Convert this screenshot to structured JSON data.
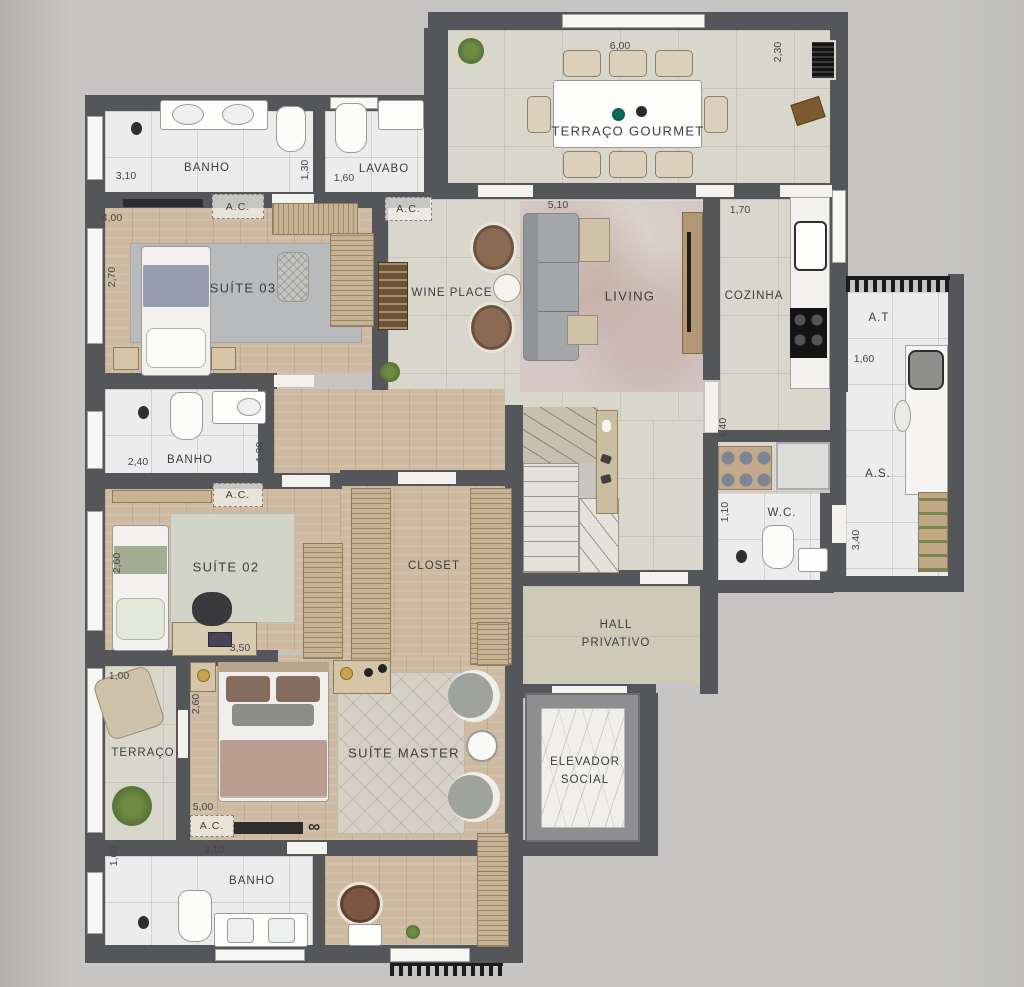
{
  "rooms": {
    "terraco_gourmet": "TERRAÇO GOURMET",
    "banho_suite03": "BANHO",
    "lavabo": "LAVABO",
    "suite_03": "SUÍTE 03",
    "wine_place": "WINE PLACE",
    "living": "LIVING",
    "cozinha": "COZINHA",
    "area_tecnica": "A.T",
    "area_servico": "A.S.",
    "banho_suite02": "BANHO",
    "suite_02": "SUÍTE 02",
    "closet": "CLOSET",
    "wc": "W.C.",
    "hall_line1": "HALL",
    "hall_line2": "PRIVATIVO",
    "elevador_line1": "ELEVADOR",
    "elevador_line2": "SOCIAL",
    "terraco": "TERRAÇO",
    "suite_master": "SUÍTE MASTER",
    "banho_master": "BANHO"
  },
  "annotations": {
    "ac": "A.C.",
    "infinity": "∞"
  },
  "dimensions": {
    "gourmet_width": "6,00",
    "gourmet_depth": "2,30",
    "banho1_width": "3,10",
    "banho1_depth": "1,30",
    "lavabo_width": "1,60",
    "suite03_width": "4,00",
    "suite03_depth": "2,70",
    "living_width": "5,10",
    "cozinha_width": "1,70",
    "corridor_depth": "4,40",
    "at_width": "1,60",
    "as_depth": "3,40",
    "banho2_width": "2,40",
    "banho2_depth": "1,30",
    "wc_depth": "1,10",
    "suite02_depth": "2,60",
    "suite02_width": "3,50",
    "terraco_width": "1,00",
    "master_depth": "2,60",
    "master_width": "5,00",
    "banho3_depth": "1,60",
    "banho3_width": "3,10"
  },
  "colors": {
    "wall": "#54565a",
    "tile_floor": "#d9d6cb",
    "white_floor": "#ebeceb",
    "wood_floor": "#cdbaa0",
    "background": "#c6c5c3",
    "plant_green": "#5f7d3e"
  }
}
